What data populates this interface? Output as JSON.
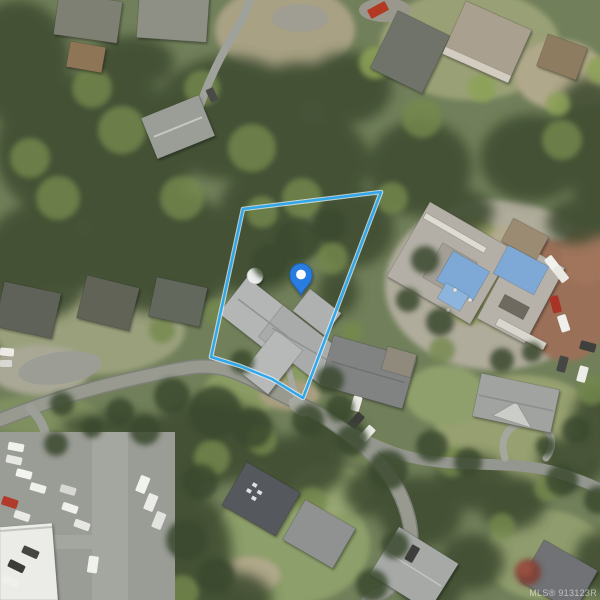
{
  "map": {
    "watermark_text": "MLS® 913123R",
    "parcel_outline": {
      "points": "243,209 381,192 303,398 272,379 240,366 211,357",
      "stroke_color": "#31a7ea",
      "casing_color": "#e4f6ff"
    },
    "marker": {
      "transform": "translate(301,295)",
      "pin_color": "#2a7de0",
      "pin_border_color": "#1c66c2",
      "dot_color": "#ffffff"
    },
    "imagery": {
      "palette": {
        "canopy_dark": "#3f4d32",
        "canopy_light": "#74894e",
        "grass_base": "#71805a",
        "road": "#989a90",
        "asphalt_parking": "#9a9c96",
        "brick_driveway": "#9b7058",
        "roof_light_gray": "#b3b6b5",
        "roof_dark_gray": "#55585c",
        "construction_tarp_blue": "#7ea8d5",
        "white_building": "#ebece8",
        "red_vehicle": "#b23a2c"
      }
    }
  }
}
